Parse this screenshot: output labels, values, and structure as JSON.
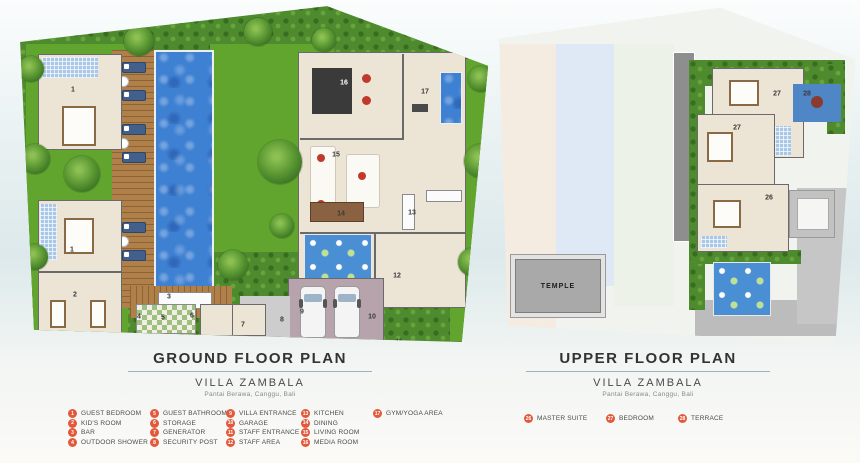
{
  "ground_floor": {
    "title": "GROUND FLOOR PLAN",
    "villa_name": "VILLA ZAMBALA",
    "location": "Pantai Berawa, Canggu, Bali",
    "markers": [
      {
        "n": "1",
        "x": 61,
        "y": 86
      },
      {
        "n": "1",
        "x": 60,
        "y": 246
      },
      {
        "n": "2",
        "x": 63,
        "y": 291
      },
      {
        "n": "3",
        "x": 157,
        "y": 293
      },
      {
        "n": "4",
        "x": 127,
        "y": 313
      },
      {
        "n": "5",
        "x": 151,
        "y": 314
      },
      {
        "n": "6",
        "x": 180,
        "y": 312
      },
      {
        "n": "7",
        "x": 231,
        "y": 321
      },
      {
        "n": "8",
        "x": 270,
        "y": 316
      },
      {
        "n": "9",
        "x": 290,
        "y": 308
      },
      {
        "n": "10",
        "x": 360,
        "y": 313
      },
      {
        "n": "11",
        "x": 387,
        "y": 338
      },
      {
        "n": "12",
        "x": 385,
        "y": 272
      },
      {
        "n": "13",
        "x": 400,
        "y": 209
      },
      {
        "n": "14",
        "x": 329,
        "y": 210
      },
      {
        "n": "15",
        "x": 324,
        "y": 151
      },
      {
        "n": "16",
        "x": 332,
        "y": 79,
        "light": true
      },
      {
        "n": "17",
        "x": 413,
        "y": 88
      }
    ]
  },
  "upper_floor": {
    "title": "UPPER FLOOR PLAN",
    "villa_name": "VILLA ZAMBALA",
    "location": "Pantai Berawa, Canggu, Bali",
    "temple_label": "TEMPLE",
    "markers": [
      {
        "n": "27",
        "x": 280,
        "y": 90
      },
      {
        "n": "28",
        "x": 310,
        "y": 90
      },
      {
        "n": "27",
        "x": 240,
        "y": 124
      },
      {
        "n": "26",
        "x": 272,
        "y": 194
      }
    ]
  },
  "legend": {
    "marker_color": "#e2593c",
    "ground_items": [
      {
        "num": "1",
        "label": "GUEST BEDROOM"
      },
      {
        "num": "2",
        "label": "KID'S ROOM"
      },
      {
        "num": "3",
        "label": "BAR"
      },
      {
        "num": "4",
        "label": "OUTDOOR SHOWER"
      },
      {
        "num": "5",
        "label": "GUEST BATHROOM"
      },
      {
        "num": "6",
        "label": "STORAGE"
      },
      {
        "num": "7",
        "label": "GENERATOR"
      },
      {
        "num": "8",
        "label": "SECURITY POST"
      },
      {
        "num": "9",
        "label": "VILLA ENTRANCE"
      },
      {
        "num": "10",
        "label": "GARAGE"
      },
      {
        "num": "11",
        "label": "STAFF ENTRANCE"
      },
      {
        "num": "12",
        "label": "STAFF AREA"
      },
      {
        "num": "13",
        "label": "KITCHEN"
      },
      {
        "num": "14",
        "label": "DINING"
      },
      {
        "num": "15",
        "label": "LIVING ROOM"
      },
      {
        "num": "16",
        "label": "MEDIA ROOM"
      },
      {
        "num": "17",
        "label": "GYM/YOGA AREA"
      }
    ],
    "upper_items": [
      {
        "num": "26",
        "label": "MASTER SUITE"
      },
      {
        "num": "27",
        "label": "BEDROOM"
      },
      {
        "num": "28",
        "label": "TERRACE"
      }
    ]
  },
  "colors": {
    "lawn": "#61a52f",
    "foliage": "#4e8a2e",
    "pool_blue": "#3e80d2",
    "pond_blue": "#4a8fd3",
    "deck_wood": "#b0804a",
    "room_floor": "#ece4d4",
    "garage_floor": "#b7a3ab",
    "roof_grey": "#8e8e8e",
    "legend_marker": "#e2593c",
    "background_tint": "#dde9eb"
  }
}
